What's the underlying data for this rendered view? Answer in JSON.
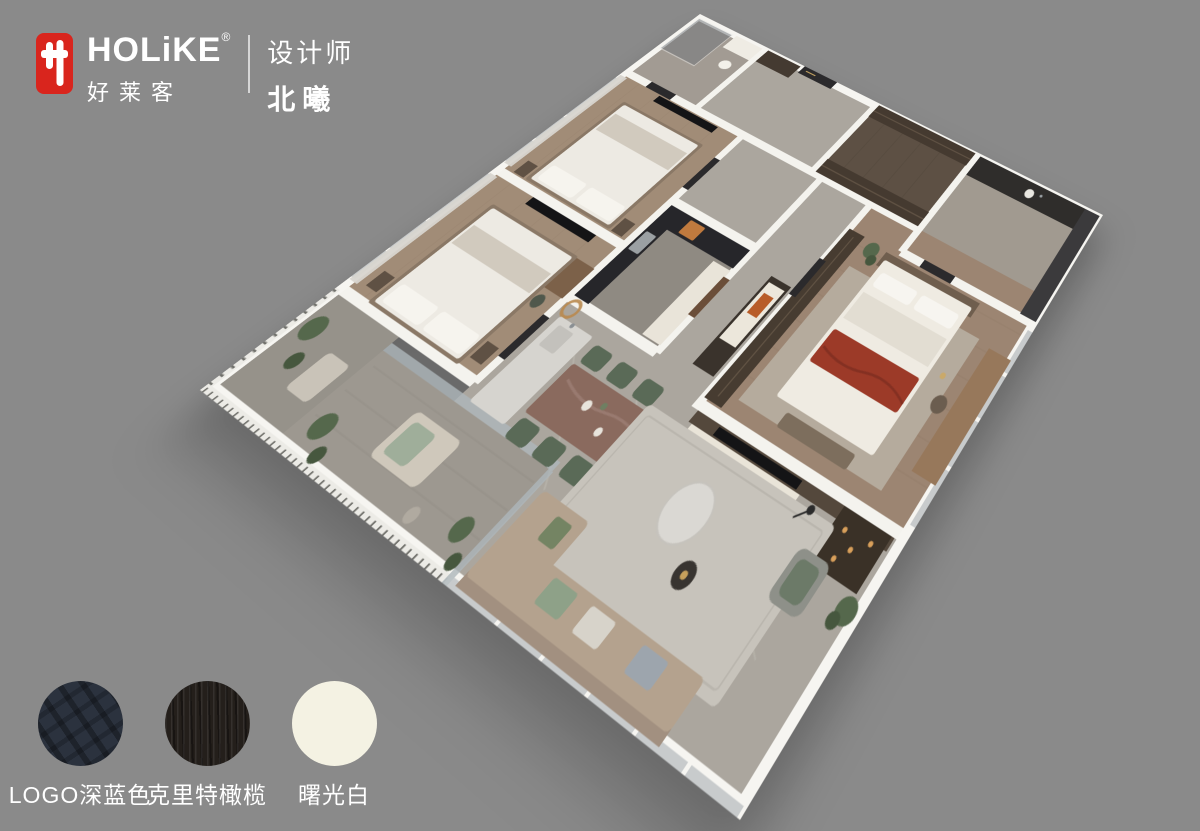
{
  "colors": {
    "background": "#8a8a8a",
    "brand_red": "#d9251d",
    "swatch_navy": "#2b323e",
    "swatch_olive": "#241f1b",
    "swatch_white": "#f4f2e3"
  },
  "header": {
    "brand_name": "HOLiKE",
    "brand_reg": "®",
    "brand_cn": "好莱客",
    "designer_label": "设计师",
    "designer_name": "北曦"
  },
  "swatches": [
    {
      "label": "LOGO深蓝色",
      "color": "#2b323e"
    },
    {
      "label": "克里特橄榄",
      "color": "#241f1b"
    },
    {
      "label": "曙光白",
      "color": "#f4f2e3"
    }
  ]
}
